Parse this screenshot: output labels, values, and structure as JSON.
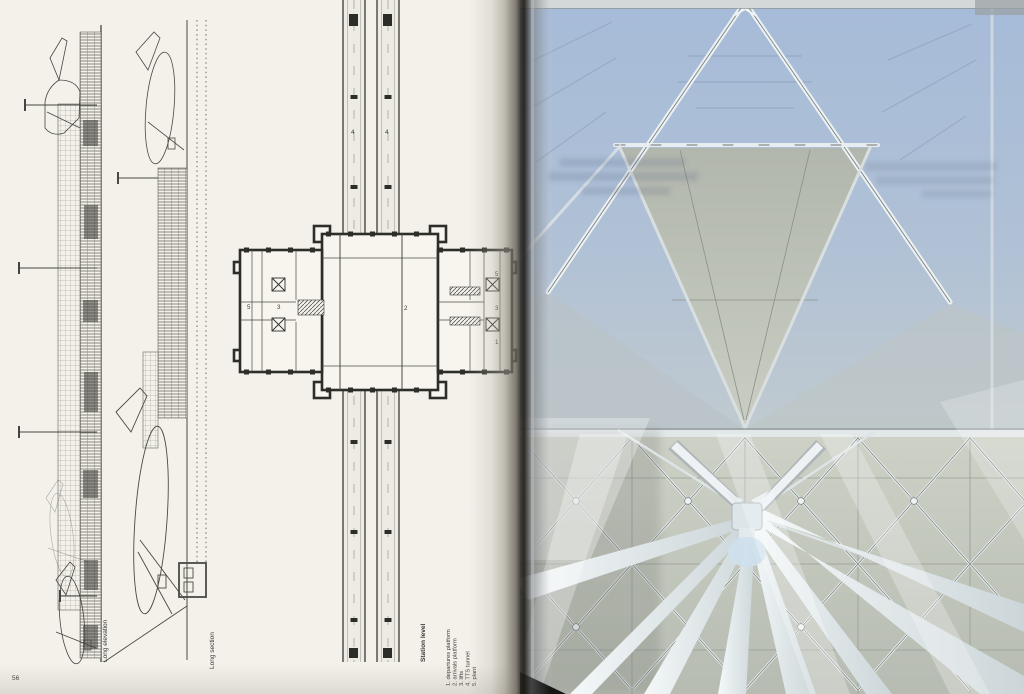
{
  "book": {
    "folio": "56",
    "left_page": {
      "figures": [
        {
          "label": "Long elevation"
        },
        {
          "label": "Long section"
        },
        {
          "label": "Station level"
        }
      ],
      "legend": {
        "items": [
          "1. departures platform",
          "2. arrivals platform",
          "3. lifts",
          "4. TTS tunnel",
          "5. plant"
        ]
      },
      "plan_numbers": {
        "track_left": "4",
        "track_right": "4",
        "left_wing_plant": "5",
        "left_wing_lifts": "3",
        "concourse": "2",
        "right_wing_plant": "5",
        "right_wing_lifts": "3",
        "right_wing_platform": "1"
      }
    },
    "colors": {
      "paper": "#f3f1ea",
      "ink": "#3c3c36",
      "sky_glazing": "#a9bdd7",
      "roof_panel": "#bfc4ba",
      "rib_white": "#e9eef1",
      "branch_white": "#f0f4f6"
    }
  }
}
